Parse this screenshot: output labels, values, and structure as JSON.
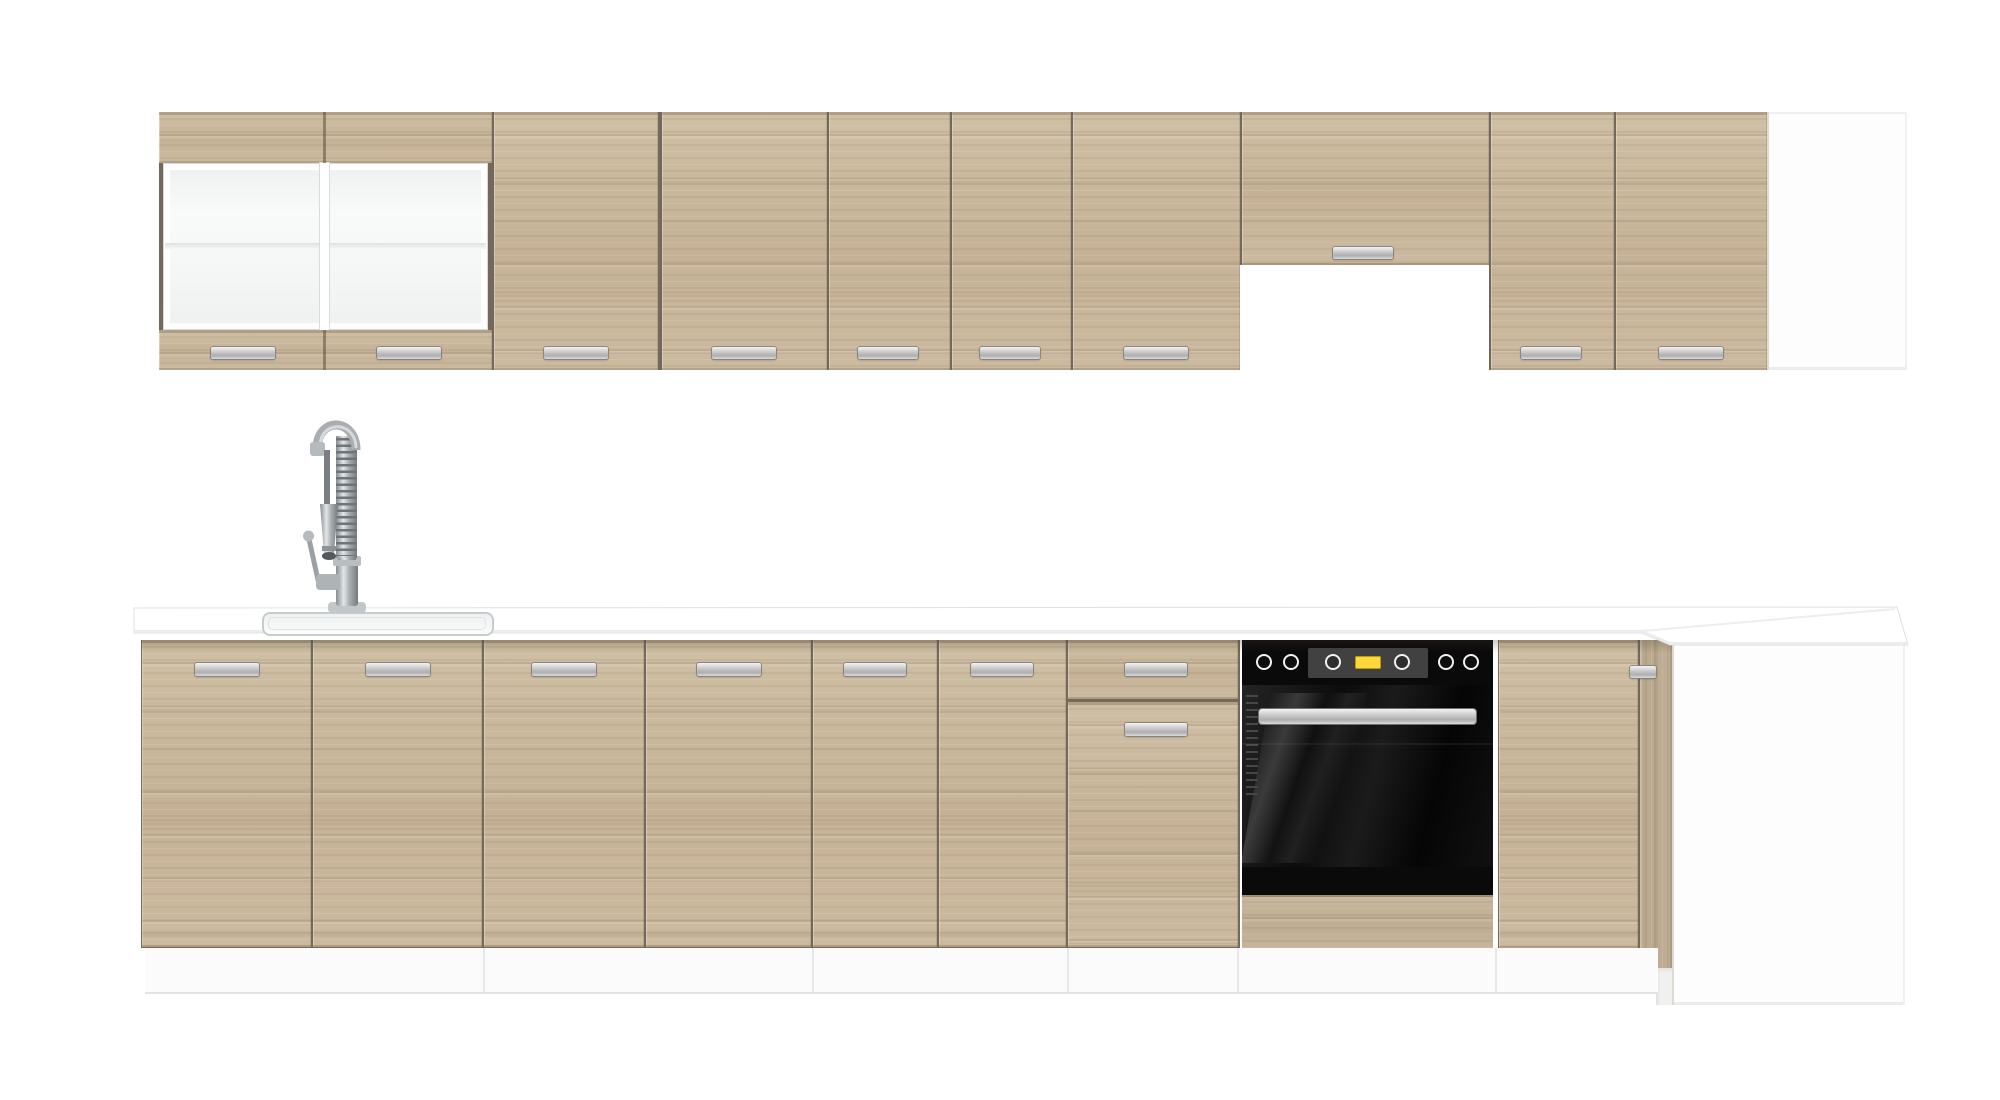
{
  "scene": {
    "description": "Product render of a straight-run kitchen furniture set in light sonoma oak with white worktop, on a plain white background",
    "background": "#ffffff"
  },
  "palette": {
    "wood": "#c8b69c",
    "wood-gap": "#73695a",
    "worktop": "#ffffff",
    "edge": "#e0e0e0",
    "panel": "#fdfdfd",
    "plinth": "#fbfbfb",
    "glass": "#f2f4f3",
    "steel": "#b9bec1",
    "oven-black": "#0a0a0a",
    "oven-recess": "#414141",
    "oven-display": "#ffd93b"
  },
  "inventory": {
    "wall_row": "Wall cabinet run",
    "glass_cabinet": "Wall display cabinet with two frosted-glass doors and middle shelf",
    "wall_door": "Wall cabinet door with steel bar handle",
    "hood_cabinet": "Short wall cabinet above cooker-hood recess",
    "hood_gap": "Open recess for cooker hood",
    "wall_end_panel": "White end panel of wall run",
    "base_row": "Base cabinet run",
    "worktop": "White straight worktop with corner return",
    "sink": "Inset single-bowl sink",
    "tap": "Chrome spring pull-down kitchen tap",
    "base_door": "Base cabinet door with steel bar handle",
    "drawer_unit": "Base unit with top drawer and door",
    "oven": "Built-in black oven with control knobs and yellow display",
    "oven_handle": "Stainless oven door handle",
    "corner_door": "Corner base cabinet door",
    "corner_filler": "Oak corner filler strip",
    "base_end_panel": "White side panel of corner base unit",
    "plinth": "White recessed plinth"
  },
  "counts": {
    "wall_glass_doors": 2,
    "wall_solid_doors": 7,
    "hood_cabinets": 1,
    "base_doors": 7,
    "drawers": 1,
    "ovens": 1,
    "end_panels": 2
  },
  "oven": {
    "outer_knobs": 4,
    "inner_knobs": 2,
    "display_color": "#ffd93b",
    "display_shape": "rounded rectangle",
    "door_finish": "gloss black with reflections"
  }
}
